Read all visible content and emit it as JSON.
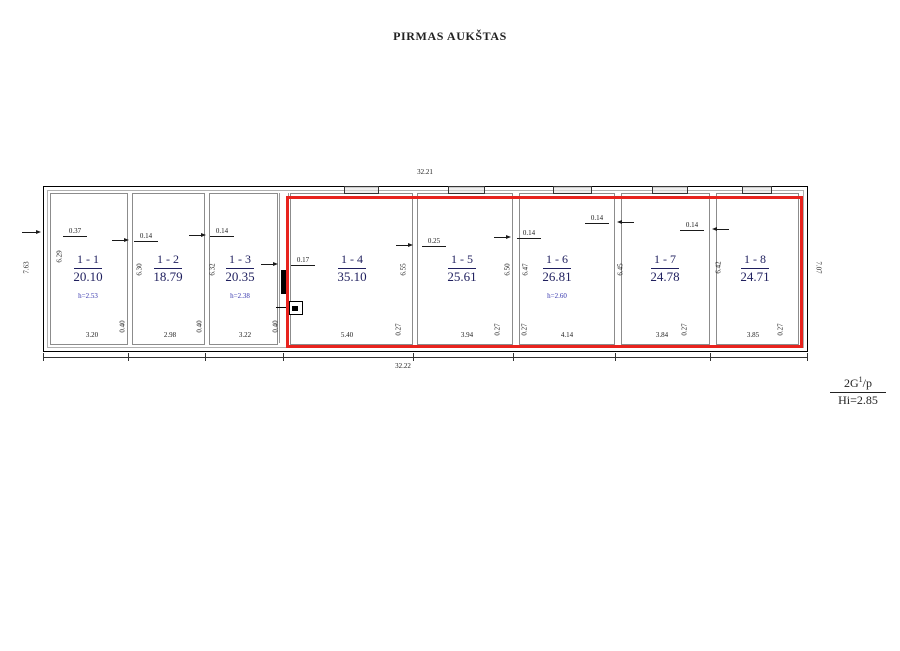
{
  "title": "PIRMAS AUKŠTAS",
  "floor_note": {
    "base": "2G",
    "sup": "1",
    "rest": "/p",
    "height": "Hi=2.85"
  },
  "overall_dims": {
    "top": "32.21",
    "bottom": "32.22",
    "left": "7.63",
    "right": "7.07"
  },
  "rooms": [
    {
      "id": "1 - 1",
      "area": "20.10",
      "note": "h=2.53",
      "width": "3.20",
      "depth": "6.29"
    },
    {
      "id": "1 - 2",
      "area": "18.79",
      "note": "",
      "width": "2.98",
      "depth": "6.30"
    },
    {
      "id": "1 - 3",
      "area": "20.35",
      "note": "h=2.38",
      "width": "3.22",
      "depth": "6.32"
    },
    {
      "id": "1 - 4",
      "area": "35.10",
      "note": "",
      "width": "5.40",
      "depth": "6.55"
    },
    {
      "id": "1 - 5",
      "area": "25.61",
      "note": "",
      "width": "3.94",
      "depth": "6.50"
    },
    {
      "id": "1 - 6",
      "area": "26.81",
      "note": "h=2.60",
      "width": "4.14",
      "depth": "6.47"
    },
    {
      "id": "1 - 7",
      "area": "24.78",
      "note": "",
      "width": "3.84",
      "depth": "6.45"
    },
    {
      "id": "1 - 8",
      "area": "24.71",
      "note": "",
      "width": "3.85",
      "depth": "6.42"
    }
  ],
  "wall_dims": {
    "left_outer": "0.37",
    "w12": "0.14",
    "w23": "0.14",
    "w34": "0.17",
    "w45": "0.25",
    "w56": "0.14",
    "w67": "0.14",
    "w78": "0.14",
    "bottom_lefts": [
      "0.40",
      "0.40",
      "0.40"
    ],
    "bottom_rights": [
      "0.27",
      "0.27",
      "0.27",
      "0.27",
      "0.27"
    ]
  },
  "colors": {
    "highlight": "#e8231e",
    "room_label": "#1f1f5e",
    "note_blue": "#3434ad"
  }
}
